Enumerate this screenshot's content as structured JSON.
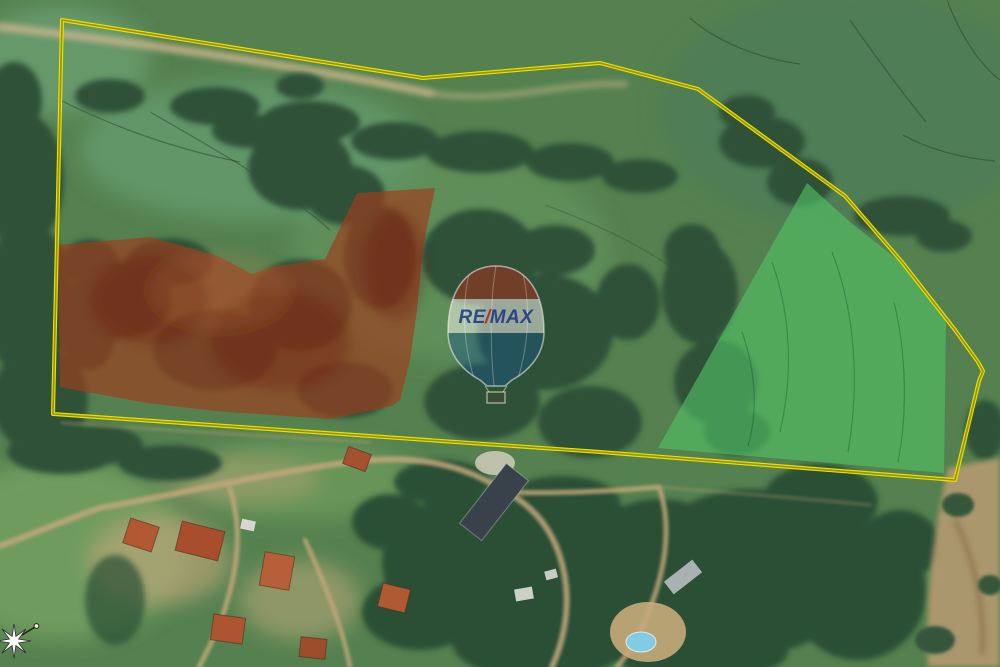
{
  "map": {
    "type": "satellite-aerial",
    "scene": "Rural land with property boundary and two highlighted parcels"
  },
  "boundary": {
    "stroke_color": "#ece000",
    "core_color": "rgba(75,78,20,0.55)",
    "points": "62,20 423,78 600,63 698,89 845,196 902,262 955,330 978,362 983,371 979,381 955,480 600,452 53,414"
  },
  "parcels": [
    {
      "id": "red-parcel",
      "fill": "#9f3c1d",
      "opacity": "0.66",
      "points": "58,245 150,237 218,256 252,274 272,267 325,259 357,193 435,188 423,247 417,310 410,360 400,400 392,406 330,419 215,411 147,403 60,387"
    },
    {
      "id": "green-parcel",
      "fill": "#52c566",
      "opacity": "0.6",
      "points": "807,183 850,222 902,263 946,322 944,473 658,448"
    }
  ],
  "watermark": {
    "brand_re": "RE",
    "brand_slash": "/",
    "brand_max": "MAX",
    "balloon_top_color": "rgba(158,52,28,0.6)",
    "balloon_band_color": "rgba(244,243,235,0.55)",
    "balloon_bottom_color": "rgba(25,85,140,0.42)",
    "text_color": "rgba(18,48,130,0.82)",
    "slash_color": "rgba(175,40,25,0.85)"
  },
  "compass": {
    "icon": "compass-star"
  }
}
